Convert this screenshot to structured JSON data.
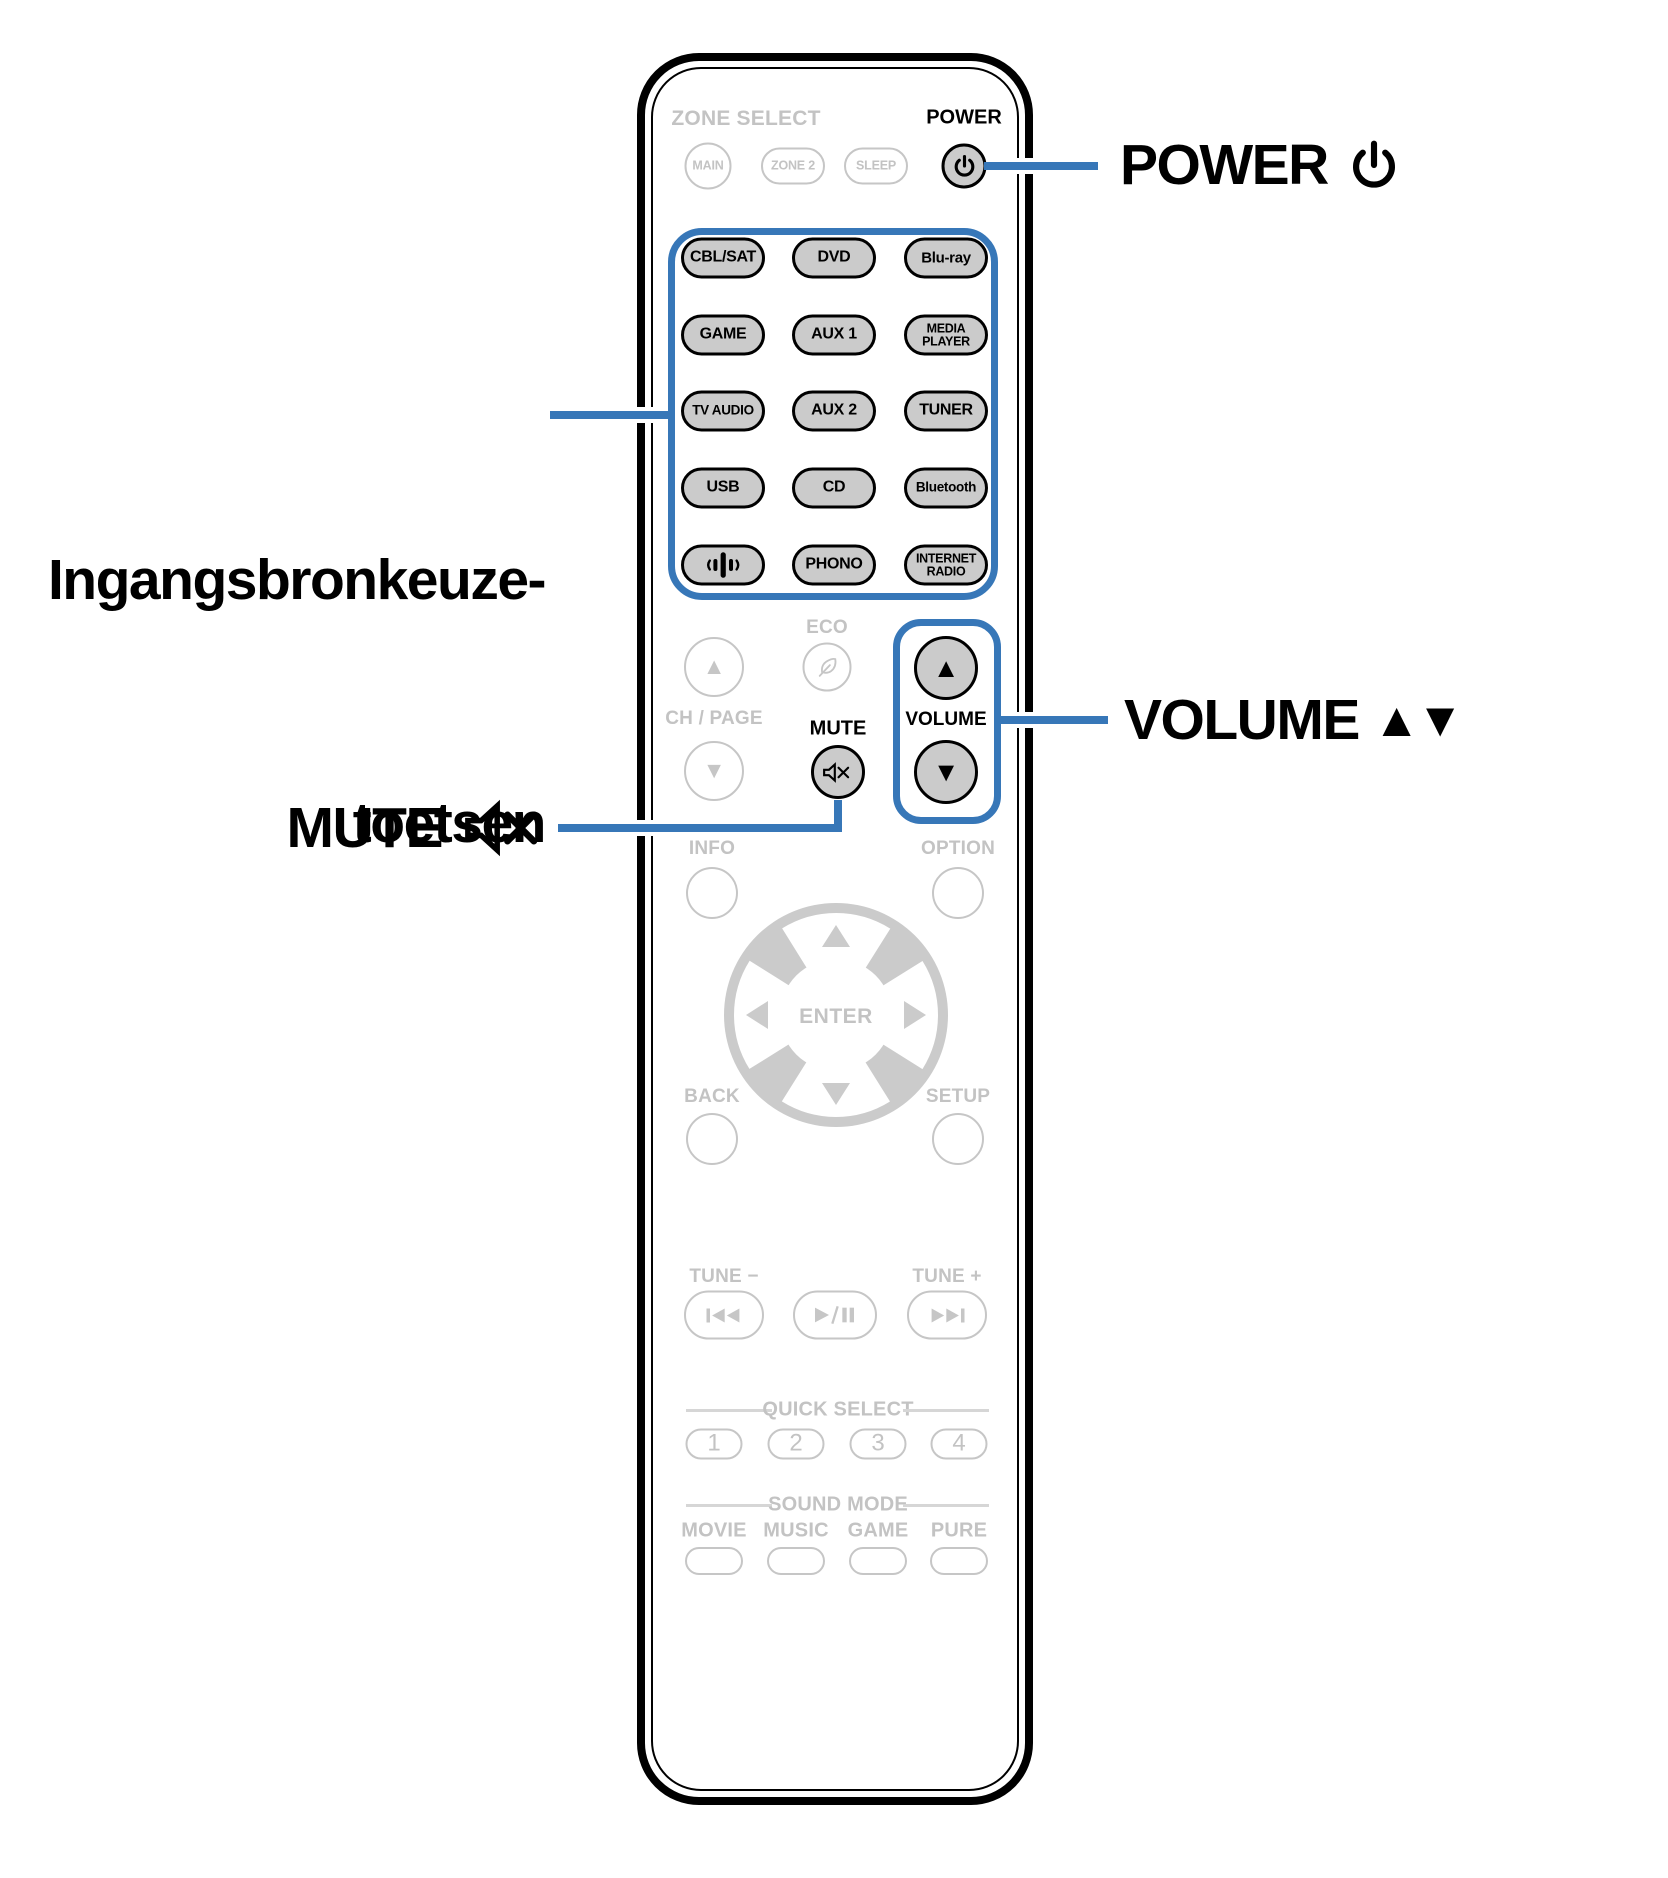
{
  "colors": {
    "accent_blue": "#3777b8",
    "button_fill": "#cbcbcb",
    "inactive_gray": "#c6c6c6",
    "text_black": "#000000"
  },
  "callouts": {
    "power": {
      "text": "POWER"
    },
    "source": {
      "line1": "Ingangsbronkeuze-",
      "line2": "toetsen"
    },
    "volume": {
      "text": "VOLUME",
      "up": "▲",
      "down": "▼"
    },
    "mute": {
      "text": "MUTE"
    }
  },
  "remote": {
    "zone": {
      "title": "ZONE SELECT",
      "main": "MAIN",
      "zone2": "ZONE 2",
      "sleep": "SLEEP"
    },
    "power_label": "POWER",
    "inputs": [
      [
        "CBL/SAT",
        "DVD",
        "Blu-ray"
      ],
      [
        "GAME",
        "AUX 1",
        "MEDIA\nPLAYER"
      ],
      [
        "TV AUDIO",
        "AUX 2",
        "TUNER"
      ],
      [
        "USB",
        "CD",
        "Bluetooth"
      ],
      [
        "",
        "PHONO",
        "INTERNET\nRADIO"
      ]
    ],
    "eco": "ECO",
    "ch_page": "CH / PAGE",
    "mute": "MUTE",
    "volume": "VOLUME",
    "up": "▲",
    "down": "▼",
    "info": "INFO",
    "option": "OPTION",
    "enter": "ENTER",
    "back": "BACK",
    "setup": "SETUP",
    "tune_minus": "TUNE −",
    "tune_plus": "TUNE +",
    "quick_select": {
      "title": "QUICK SELECT",
      "buttons": [
        "1",
        "2",
        "3",
        "4"
      ]
    },
    "sound_mode": {
      "title": "SOUND MODE",
      "modes": [
        "MOVIE",
        "MUSIC",
        "GAME",
        "PURE"
      ]
    }
  }
}
